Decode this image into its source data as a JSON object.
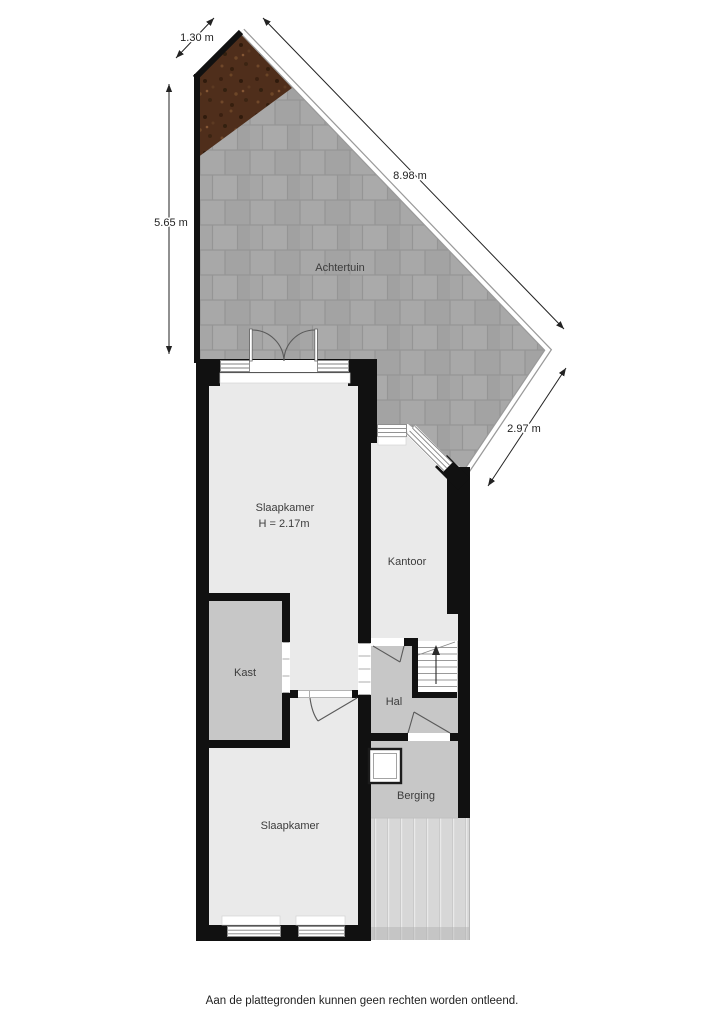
{
  "plan": {
    "rooms": [
      {
        "key": "achtertuin",
        "label": "Achtertuin"
      },
      {
        "key": "slaapkamer_boven",
        "label": "Slaapkamer",
        "height_note": "H = 2.17m"
      },
      {
        "key": "kantoor",
        "label": "Kantoor"
      },
      {
        "key": "kast",
        "label": "Kast"
      },
      {
        "key": "hal",
        "label": "Hal"
      },
      {
        "key": "berging",
        "label": "Berging"
      },
      {
        "key": "slaapkamer_onder",
        "label": "Slaapkamer"
      }
    ],
    "dimensions": [
      {
        "key": "top_slant_edge",
        "label": "1.30 m"
      },
      {
        "key": "left_edge",
        "label": "5.65 m"
      },
      {
        "key": "diagonal_edge",
        "label": "8.98 m"
      },
      {
        "key": "lower_right_edge",
        "label": "2.97 m"
      }
    ],
    "disclaimer": "Aan de plattegronden kunnen geen rechten worden ontleend.",
    "colors": {
      "wall": "#111111",
      "room_floor": "#eaeaea",
      "service_floor": "#c7c7c7",
      "garden_tile": "#a5a5a5",
      "garden_grout": "#959595",
      "dirt_brown": "#4f2e1b",
      "deck_base": "#d7d7d7",
      "deck_stripe": "#e9e9e9",
      "dimension_text": "#222222",
      "label_text": "#3c3c3c"
    }
  }
}
